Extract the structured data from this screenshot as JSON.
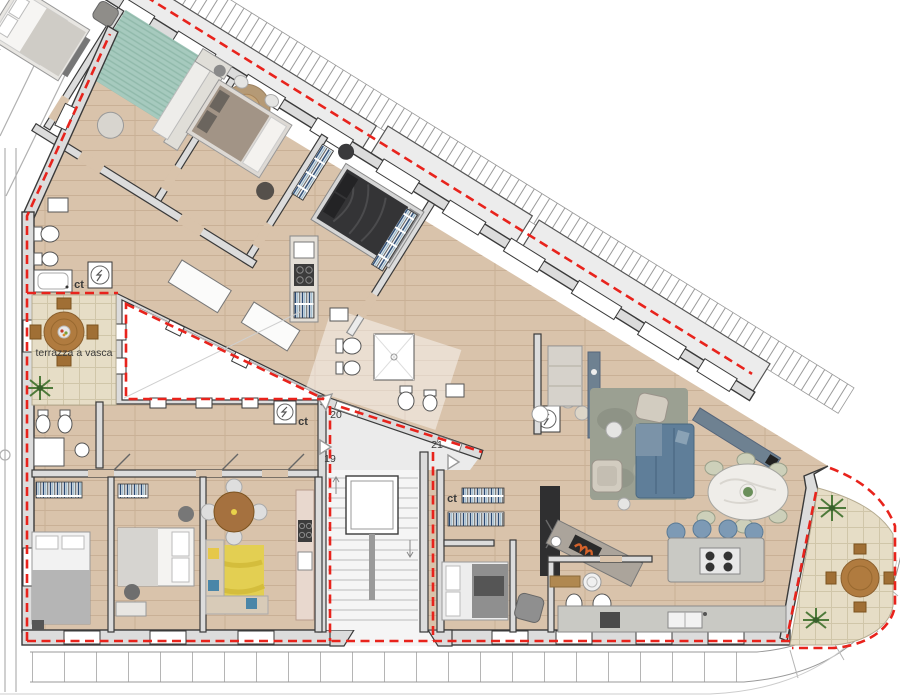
{
  "plan": {
    "terrace_label": "terrazza a vasca",
    "closet_label": "ct",
    "unit_numbers": [
      "19",
      "20",
      "21"
    ],
    "colors": {
      "boundary_red": "#e8231c",
      "wall_fill": "#dcdcdc",
      "wall_line": "#3a3a3a",
      "wood_floor": "#d9c3ab",
      "tile_floor": "#e6ddc6",
      "teal_rug": "#a6cabe",
      "yellow_rug": "#e3cf52",
      "blue_sofa": "#5f7e99",
      "slate_blue": "#6e8191",
      "dark_bed": "#343436",
      "wood_furniture": "#b07b3f",
      "plant_green": "#4e7a3a"
    }
  }
}
